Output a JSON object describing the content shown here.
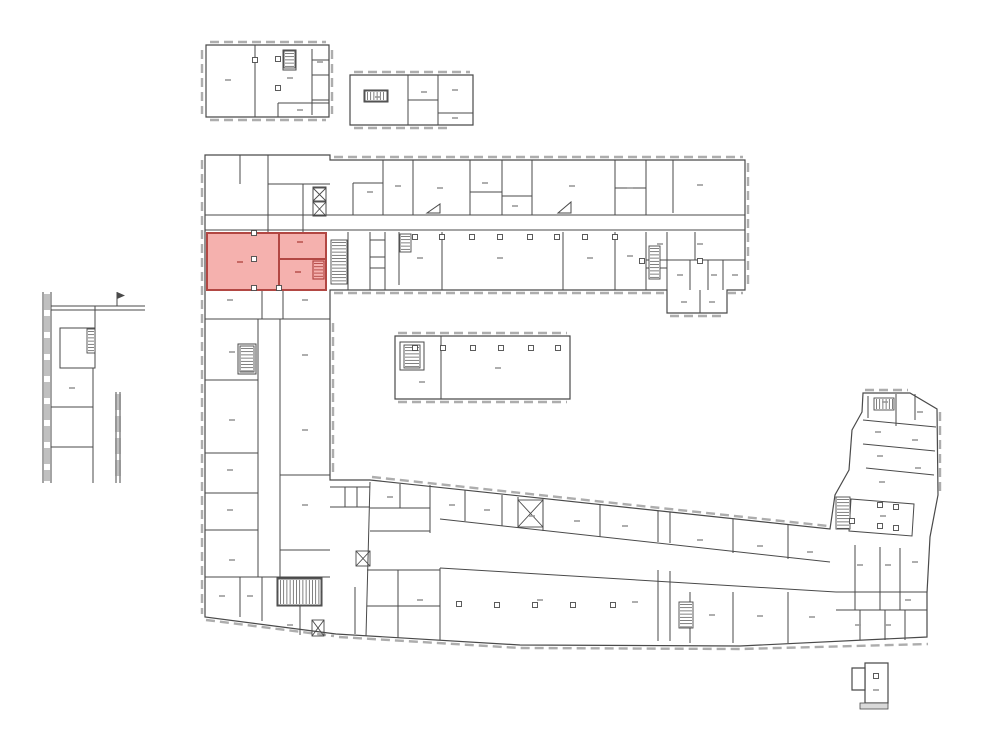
{
  "canvas": {
    "width": 1000,
    "height": 753,
    "background": "#ffffff"
  },
  "plan": {
    "colors": {
      "wall": "#4a4a4a",
      "window_band": "#8d8d8d",
      "label_mark": "#9a9a9a"
    },
    "outlines": [
      "M206,45 H329 V117 H206 Z",
      "M350,75 H473 V125 H350 Z",
      "M205,155 H330 V160 H745 V290 H727 V313 H667 V290 H330 V480 L370,480 L830,529 L835,495 L849,470 L852,430 L862,412 L863,393 L910,393 L937,409 L938,495 L930,537 L927,593 L927,637 L740,646 L520,645 L336,634 L205,617 Z",
      "M395,336 H570 V399 H395 Z",
      "M865,663 H888 V703 H865 Z",
      "M852,668 H865 V690 H852 Z"
    ],
    "walls": [
      "M255,45 V117",
      "M312,49 V115",
      "M312,60 H329",
      "M312,75 H329",
      "M312,100 H329",
      "M278,103 H329",
      "M278,103 V117",
      "M283,50 H296 V70 H283 Z",
      "M408,75 V125",
      "M438,75 V125",
      "M408,100 H438",
      "M438,113 H473",
      "M364,90 H388 V102 H364 Z",
      "M43,292 V483",
      "M51,292 V483",
      "M51,306 H145",
      "M51,310 H145",
      "M95,306 V328",
      "M60,328 H95 V368 H60 Z",
      "M93,368 V483",
      "M51,407 H93",
      "M51,447 H93",
      "M116,392 V483",
      "M120,392 V483",
      "M117,306 V292",
      "M240,155 V184",
      "M268,155 V232",
      "M268,184 H330",
      "M303,184 V232",
      "M313,187 H326 V216 H313 Z",
      "M313,201 H326",
      "M205,215 H745",
      "M205,230 H745",
      "M348,232 V290",
      "M370,232 V290",
      "M385,232 V290",
      "M370,240 H385",
      "M370,257 H385",
      "M370,268 H385",
      "M262,290 V319",
      "M283,290 V319",
      "M205,319 H330",
      "M258,319 V577",
      "M280,319 V577",
      "M205,380 H258",
      "M205,453 H258",
      "M205,493 H258",
      "M205,530 H258",
      "M280,475 H330",
      "M280,550 H330",
      "M238,344 H256 V374 H238 Z",
      "M205,577 H330",
      "M240,577 V617",
      "M262,577 V621",
      "M277,578 H322 V606 H277 Z",
      "M277,592 H322",
      "M300,606 V635",
      "M355,587 V634",
      "M383,160 V215",
      "M413,160 V215",
      "M470,160 V215",
      "M502,160 V215",
      "M532,160 V215",
      "M615,160 V215",
      "M646,160 V215",
      "M673,160 V213",
      "M353,183 V215",
      "M353,183 H383",
      "M470,192 H502",
      "M502,196 H532",
      "M615,188 H646",
      "M427,213 L440,213 L440,204 Z",
      "M558,213 L571,213 L571,202 Z",
      "M399,232 V285",
      "M442,232 V290",
      "M563,232 V290",
      "M615,232 V290",
      "M646,232 V290",
      "M667,232 V290",
      "M695,232 V260",
      "M646,260 H745",
      "M690,260 V290",
      "M708,260 V290",
      "M723,260 V290",
      "M700,290 V313",
      "M646,268 H667",
      "M441,336 V399",
      "M400,342 H424 V370 H400 Z",
      "M370,482 L366,636",
      "M330,487 H370",
      "M330,507 H370",
      "M345,487 V507",
      "M357,487 V507",
      "M400,484 V508",
      "M370,508 H430",
      "M370,531 H430",
      "M430,485 V533",
      "M440,519 L830,562",
      "M465,490 V521",
      "M502,495 V526",
      "M518,497 V528",
      "M543,499 V531",
      "M600,505 V537",
      "M658,511 V542",
      "M670,512 V543",
      "M733,519 V553",
      "M788,525 V559",
      "M440,568 L836,592",
      "M836,592 H927",
      "M367,570 H440",
      "M440,568 V640",
      "M398,570 V638",
      "M367,606 H440",
      "M658,570 V641",
      "M670,571 V641",
      "M690,592 V643",
      "M733,592 V643",
      "M788,592 V643",
      "M863,420 L936,427",
      "M863,444 L935,451",
      "M866,468 L934,475",
      "M868,396 V418",
      "M896,394 V426",
      "M915,394 V420",
      "M851,499 L914,504 L912,536 L849,531 Z",
      "M836,610 H927",
      "M855,545 V610",
      "M880,547 V610",
      "M900,548 V610",
      "M860,610 V640",
      "M885,610 V640",
      "M905,610 V640"
    ],
    "windows": [
      "M210,42 H326",
      "M202,50 V114",
      "M210,120 H326",
      "M332,50 V114",
      "M354,72 H470",
      "M354,128 H452",
      "M202,160 V614",
      "M334,157 H743",
      "M748,163 V287",
      "M334,293 H664",
      "M670,316 H724",
      "M727,293 H743",
      "M333,323 V477",
      "M372,477 L828,526",
      "M339,637 L520,648 L740,649 L928,644",
      "M206,620 L334,636",
      "M398,333 H567",
      "M398,402 H567",
      "M865,390 H908",
      "M940,412 V492"
    ],
    "windows_thick": [
      "M47,294 V481",
      "M118,394 V481"
    ],
    "stairs": [
      {
        "x": 284,
        "y": 51,
        "w": 11,
        "h": 17,
        "dir": "v"
      },
      {
        "x": 365,
        "y": 91,
        "w": 22,
        "h": 10,
        "dir": "h"
      },
      {
        "x": 87,
        "y": 329,
        "w": 8,
        "h": 24,
        "dir": "v"
      },
      {
        "x": 240,
        "y": 346,
        "w": 14,
        "h": 26,
        "dir": "v"
      },
      {
        "x": 331,
        "y": 240,
        "w": 16,
        "h": 44,
        "dir": "v"
      },
      {
        "x": 400,
        "y": 234,
        "w": 11,
        "h": 18,
        "dir": "v"
      },
      {
        "x": 649,
        "y": 246,
        "w": 11,
        "h": 33,
        "dir": "v"
      },
      {
        "x": 278,
        "y": 579,
        "w": 43,
        "h": 26,
        "dir": "h"
      },
      {
        "x": 679,
        "y": 602,
        "w": 14,
        "h": 26,
        "dir": "v"
      },
      {
        "x": 874,
        "y": 398,
        "w": 20,
        "h": 12,
        "dir": "h"
      },
      {
        "x": 836,
        "y": 497,
        "w": 14,
        "h": 32,
        "dir": "v"
      },
      {
        "x": 404,
        "y": 345,
        "w": 16,
        "h": 23,
        "dir": "v"
      }
    ],
    "shafts": [
      {
        "x": 313,
        "y": 188,
        "w": 13,
        "h": 13
      },
      {
        "x": 313,
        "y": 202,
        "w": 13,
        "h": 14
      },
      {
        "x": 312,
        "y": 620,
        "w": 12,
        "h": 16
      },
      {
        "x": 356,
        "y": 551,
        "w": 14,
        "h": 15
      },
      {
        "x": 518,
        "y": 500,
        "w": 25,
        "h": 27
      }
    ],
    "columns": [
      [
        255,
        60
      ],
      [
        278,
        59
      ],
      [
        278,
        88
      ],
      [
        415,
        348
      ],
      [
        443,
        348
      ],
      [
        473,
        348
      ],
      [
        501,
        348
      ],
      [
        531,
        348
      ],
      [
        558,
        348
      ],
      [
        415,
        237
      ],
      [
        442,
        237
      ],
      [
        472,
        237
      ],
      [
        500,
        237
      ],
      [
        530,
        237
      ],
      [
        557,
        237
      ],
      [
        585,
        237
      ],
      [
        615,
        237
      ],
      [
        642,
        261
      ],
      [
        700,
        261
      ],
      [
        254,
        233
      ],
      [
        254,
        259
      ],
      [
        254,
        288
      ],
      [
        279,
        288
      ],
      [
        459,
        604
      ],
      [
        497,
        605
      ],
      [
        535,
        605
      ],
      [
        573,
        605
      ],
      [
        613,
        605
      ],
      [
        880,
        505
      ],
      [
        896,
        507
      ],
      [
        880,
        526
      ],
      [
        896,
        528
      ],
      [
        852,
        521
      ],
      [
        876,
        676
      ]
    ],
    "labels": [
      [
        228,
        80
      ],
      [
        290,
        78
      ],
      [
        320,
        62
      ],
      [
        300,
        110
      ],
      [
        378,
        97
      ],
      [
        424,
        92
      ],
      [
        455,
        90
      ],
      [
        455,
        118
      ],
      [
        370,
        192
      ],
      [
        398,
        186
      ],
      [
        440,
        188
      ],
      [
        485,
        183
      ],
      [
        515,
        206
      ],
      [
        572,
        186
      ],
      [
        630,
        188
      ],
      [
        700,
        185
      ],
      [
        420,
        258
      ],
      [
        500,
        258
      ],
      [
        590,
        258
      ],
      [
        630,
        256
      ],
      [
        660,
        244
      ],
      [
        700,
        244
      ],
      [
        680,
        275
      ],
      [
        714,
        275
      ],
      [
        735,
        275
      ],
      [
        684,
        302
      ],
      [
        712,
        302
      ],
      [
        230,
        300
      ],
      [
        305,
        300
      ],
      [
        232,
        352
      ],
      [
        232,
        420
      ],
      [
        230,
        470
      ],
      [
        230,
        510
      ],
      [
        232,
        560
      ],
      [
        305,
        355
      ],
      [
        305,
        430
      ],
      [
        305,
        505
      ],
      [
        222,
        596
      ],
      [
        250,
        596
      ],
      [
        290,
        625
      ],
      [
        72,
        388
      ],
      [
        422,
        382
      ],
      [
        498,
        368
      ],
      [
        390,
        497
      ],
      [
        452,
        505
      ],
      [
        487,
        510
      ],
      [
        532,
        516
      ],
      [
        577,
        521
      ],
      [
        625,
        526
      ],
      [
        700,
        540
      ],
      [
        760,
        546
      ],
      [
        810,
        552
      ],
      [
        420,
        600
      ],
      [
        540,
        600
      ],
      [
        635,
        602
      ],
      [
        712,
        615
      ],
      [
        760,
        616
      ],
      [
        812,
        617
      ],
      [
        885,
        402
      ],
      [
        920,
        412
      ],
      [
        878,
        432
      ],
      [
        915,
        440
      ],
      [
        880,
        456
      ],
      [
        918,
        468
      ],
      [
        882,
        482
      ],
      [
        883,
        516
      ],
      [
        860,
        565
      ],
      [
        888,
        565
      ],
      [
        915,
        562
      ],
      [
        858,
        625
      ],
      [
        888,
        625
      ],
      [
        908,
        600
      ],
      [
        876,
        690
      ]
    ],
    "flag": "M117,292 L125,295.5 L117,299 Z",
    "sill": {
      "x": 860,
      "y": 703,
      "w": 28,
      "h": 6
    }
  },
  "highlight": {
    "fill": "#f29e9a",
    "stroke": "#b24743",
    "opacity": 0.8,
    "rooms": [
      "M207,233 H279 V290 H207 Z",
      "M279,233 H326 V259 H279 Z",
      "M279,259 H326 V290 H279 Z"
    ],
    "stair": {
      "x": 313,
      "y": 261,
      "w": 11,
      "h": 18,
      "dir": "v"
    },
    "labels": [
      [
        240,
        262
      ],
      [
        300,
        242
      ],
      [
        298,
        272
      ]
    ]
  }
}
